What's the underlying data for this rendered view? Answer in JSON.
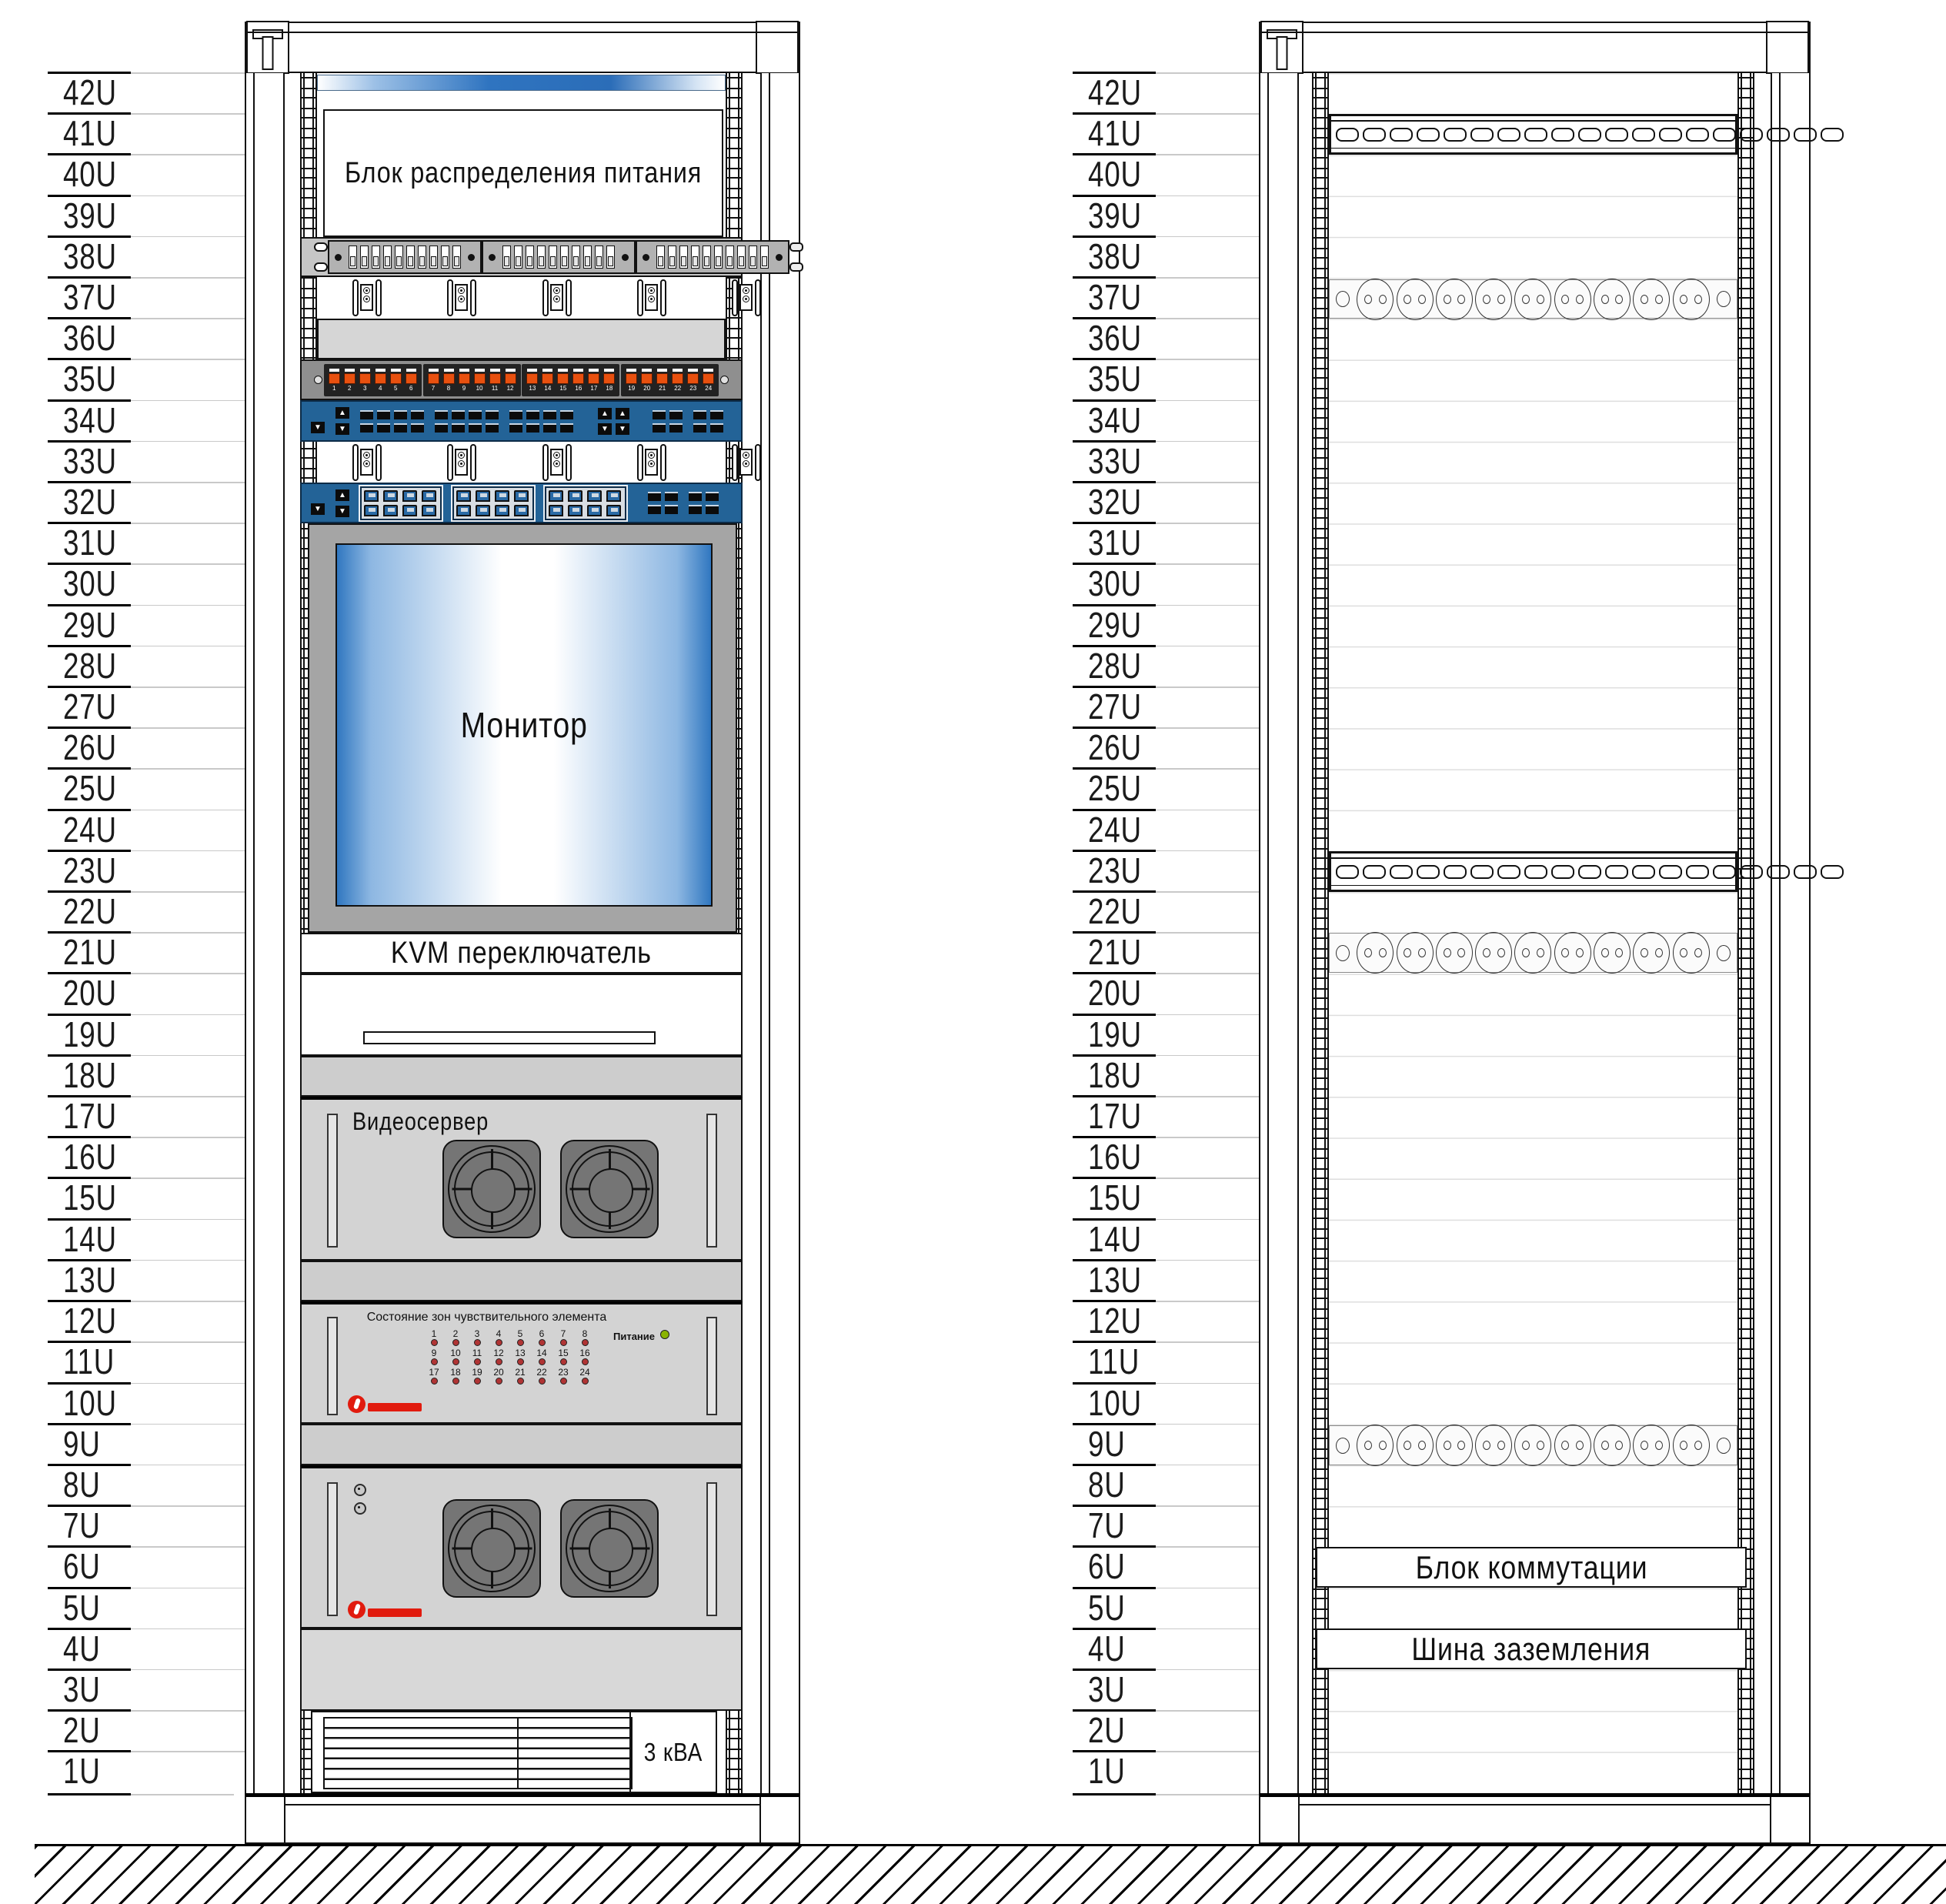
{
  "u_labels": [
    "42U",
    "41U",
    "40U",
    "39U",
    "38U",
    "37U",
    "36U",
    "35U",
    "34U",
    "33U",
    "32U",
    "31U",
    "30U",
    "29U",
    "28U",
    "27U",
    "26U",
    "25U",
    "24U",
    "23U",
    "22U",
    "21U",
    "20U",
    "19U",
    "18U",
    "17U",
    "16U",
    "15U",
    "14U",
    "13U",
    "12U",
    "11U",
    "10U",
    "9U",
    "8U",
    "7U",
    "6U",
    "5U",
    "4U",
    "3U",
    "2U",
    "1U"
  ],
  "left_rack": {
    "pdu": {
      "label": "Блок распределения питания"
    },
    "breakers_per_group": 10,
    "cable_hooks": 5,
    "patch_panel": {
      "groups": [
        [
          "1",
          "2",
          "3",
          "4",
          "5",
          "6"
        ],
        [
          "7",
          "8",
          "9",
          "10",
          "11",
          "12"
        ],
        [
          "13",
          "14",
          "15",
          "16",
          "17",
          "18"
        ],
        [
          "19",
          "20",
          "21",
          "22",
          "23",
          "24"
        ]
      ]
    },
    "switch_ports_per_group": 8,
    "monitor": {
      "label": "Монитор"
    },
    "kvm": {
      "label": "KVM переключатель"
    },
    "video_server": {
      "label": "Видеосервер"
    },
    "sensor_unit": {
      "title": "Состояние зон чувствительного элемента",
      "power_label": "Питание",
      "zones": [
        "1",
        "2",
        "3",
        "4",
        "5",
        "6",
        "7",
        "8",
        "9",
        "10",
        "11",
        "12",
        "13",
        "14",
        "15",
        "16",
        "17",
        "18",
        "19",
        "20",
        "21",
        "22",
        "23",
        "24"
      ]
    },
    "ups": {
      "label": "3 кВА"
    }
  },
  "right_rack": {
    "duct_slots": 19,
    "sockets": 9,
    "commutation": {
      "label": "Блок коммутации"
    },
    "ground_bus": {
      "label": "Шина заземления"
    }
  },
  "colors": {
    "switch_blue": "#236397",
    "port_orange": "#e8500f",
    "screen_blue": "#3077c0",
    "led_red": "#b03434",
    "led_green": "#8ab300",
    "logo_red": "#e11b0e",
    "line": "#111111"
  }
}
